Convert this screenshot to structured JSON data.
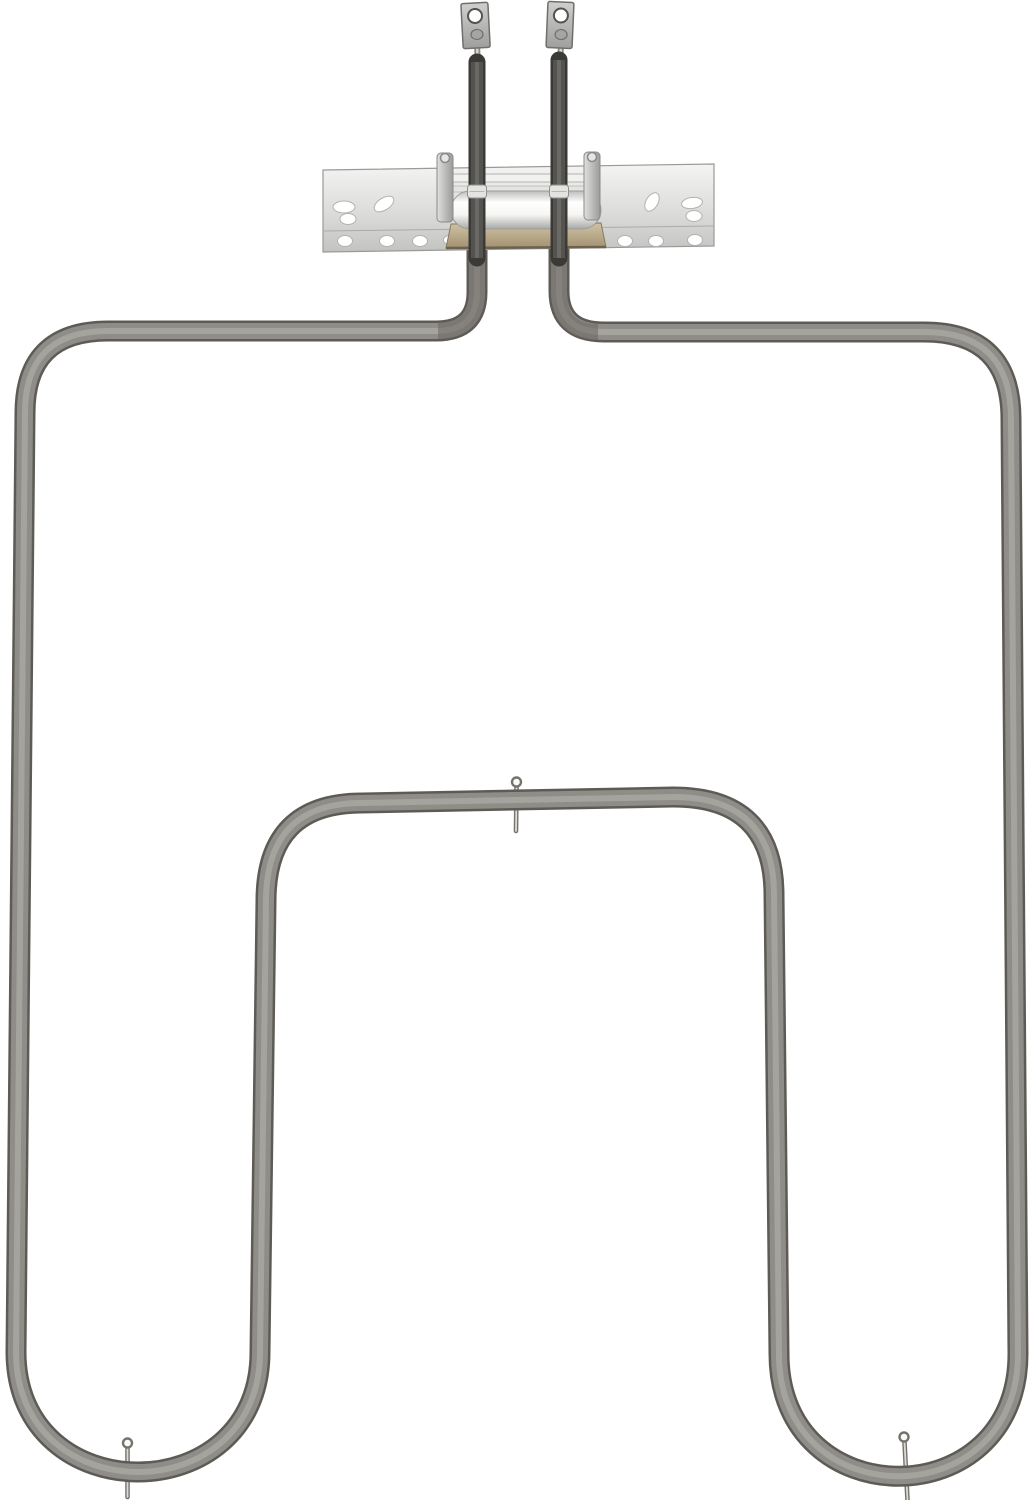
{
  "meta": {
    "domain": "Natural-Image",
    "subject": "Oven bake heating element replacement part photographed on a white background",
    "background_color": "#ffffff"
  },
  "object": {
    "description": "Large square-cornered outer tube loop descending from a top mounting bracket, with an inner upside-down-U run; two dark terminal sheaths pass through the bracket up to two metal spade terminals",
    "terminal_count": 2,
    "support_pin_count": 3,
    "bracket_hole_count": 14
  },
  "palette": {
    "background": "#ffffff",
    "tube_edge": "#5e5b56",
    "tube_body": "#8f8d88",
    "tube_highlight": "#a9a7a2",
    "terminal_sheath_dark": "#3c3a37",
    "terminal_sheath_mid": "#555350",
    "bracket_light": "#f4f4f2",
    "bracket_dark": "#c3c3c1",
    "bracket_edge": "#9a9a98",
    "base_plate_tan": "#b4a583",
    "pin_metal": "#76736e"
  },
  "drawing": {
    "viewbox": "0 0 1036 1500",
    "tube": {
      "path": "M 477,248 L 477,292 Q 477,331 436,331 L 108,331 Q 25,331 25,413 L 16,1352 C 16,1512 260,1512 260,1352 L 266,901 Q 266,803 362,803 L 673,797 Q 774,797 774,895 L 779,1354 C 779,1517 1018,1517 1018,1354 L 1011,419 Q 1011,332 924,332 L 604,332 Q 559,332 559,291 L 559,248",
      "passes": [
        {
          "color": "#5e5b56",
          "width": 21
        },
        {
          "color": "#8f8d88",
          "width": 16
        },
        {
          "color": "#a9a7a2",
          "width": 6
        }
      ],
      "elbow_shadows": [
        "M 477,250 L 477,292 Q 477,331 438,331",
        "M 559,250 L 559,291 Q 559,332 598,332"
      ],
      "elbow_shadow_color": "#6b6862",
      "elbow_shadow_width": 16,
      "elbow_shadow_opacity": 0.55
    },
    "pins": [
      {
        "x1": 516.5,
        "y1": 787,
        "x2": 516,
        "y2": 831,
        "loop": {
          "cx": 516.5,
          "cy": 782,
          "r": 4.5
        }
      },
      {
        "x1": 127.5,
        "y1": 1448,
        "x2": 127.5,
        "y2": 1497,
        "loop": {
          "cx": 127.5,
          "cy": 1443,
          "r": 4.5
        }
      },
      {
        "x1": 904.5,
        "y1": 1442,
        "x2": 907.5,
        "y2": 1500,
        "loop": {
          "cx": 904,
          "cy": 1437,
          "r": 4.5
        }
      }
    ],
    "bracket": {
      "strip": "323,170 714,164 714,246 323,252",
      "crease": {
        "x1": 323,
        "y1": 231,
        "x2": 714,
        "y2": 226
      },
      "holes": [
        {
          "cx": 344,
          "cy": 207,
          "rx": 11,
          "ry": 6,
          "rot": 0
        },
        {
          "cx": 348,
          "cy": 219,
          "rx": 8,
          "ry": 5.5,
          "rot": 0
        },
        {
          "cx": 384,
          "cy": 204,
          "rx": 11,
          "ry": 6,
          "rot": -33
        },
        {
          "cx": 345,
          "cy": 241,
          "rx": 7.5,
          "ry": 5.5,
          "rot": 0
        },
        {
          "cx": 387,
          "cy": 241,
          "rx": 7.5,
          "ry": 5.5,
          "rot": 0
        },
        {
          "cx": 420,
          "cy": 241,
          "rx": 7.5,
          "ry": 5.5,
          "rot": 0
        },
        {
          "cx": 451,
          "cy": 240,
          "rx": 7.5,
          "ry": 5,
          "rot": 0
        },
        {
          "cx": 652,
          "cy": 202,
          "rx": 10,
          "ry": 6,
          "rot": -60
        },
        {
          "cx": 692,
          "cy": 203,
          "rx": 10.5,
          "ry": 5.5,
          "rot": -8
        },
        {
          "cx": 694,
          "cy": 216,
          "rx": 8,
          "ry": 5.5,
          "rot": 0
        },
        {
          "cx": 592,
          "cy": 240,
          "rx": 7.5,
          "ry": 5,
          "rot": 0
        },
        {
          "cx": 625,
          "cy": 241,
          "rx": 7.5,
          "ry": 5.5,
          "rot": 0
        },
        {
          "cx": 656,
          "cy": 241,
          "rx": 7.5,
          "ry": 5.5,
          "rot": 0
        },
        {
          "cx": 695,
          "cy": 240,
          "rx": 7.5,
          "ry": 5.5,
          "rot": 0
        }
      ],
      "plate": "451,224 601,223 606,247 446,248",
      "plate_bottom_edge": {
        "x1": 446,
        "y1": 248,
        "x2": 606,
        "y2": 247
      },
      "rods": [
        {
          "x": 440,
          "y": 174,
          "w": 158,
          "h": 8
        },
        {
          "x": 440,
          "y": 186,
          "w": 158,
          "h": 6
        }
      ],
      "cylinder": {
        "x": 451,
        "y": 191,
        "w": 150,
        "h": 38
      },
      "clips": [
        {
          "x": 437,
          "y": 153,
          "w": 16,
          "h": 69
        },
        {
          "x": 584,
          "y": 152,
          "w": 16,
          "h": 68
        }
      ],
      "rivets": [
        {
          "cx": 445,
          "cy": 158,
          "r": 4.5
        },
        {
          "cx": 592,
          "cy": 157,
          "r": 4.5
        }
      ]
    },
    "terminals": {
      "necks": [
        {
          "x1": 477,
          "y1": 44,
          "x2": 478,
          "y2": 67
        },
        {
          "x1": 561,
          "y1": 44,
          "x2": 560,
          "y2": 67
        }
      ],
      "tubes": [
        {
          "x1": 477,
          "y1": 62,
          "x2": 477,
          "y2": 258
        },
        {
          "x1": 559,
          "y1": 60,
          "x2": 559,
          "y2": 258
        }
      ],
      "tube_passes": [
        {
          "color": "#3c3a37",
          "width": 17
        },
        {
          "color": "#555350",
          "width": 12
        },
        {
          "color": "#6b6965",
          "width": 4
        }
      ],
      "collars": [
        {
          "x": 467.5,
          "y": 185,
          "w": 19,
          "h": 13
        },
        {
          "x": 549.5,
          "y": 185,
          "w": 19,
          "h": 13
        }
      ],
      "tabs": [
        {
          "x": 462,
          "y": 3,
          "w": 27,
          "h": 45,
          "rot": -3,
          "cx": 475.5,
          "cy": 25,
          "hole": {
            "cx": 475.5,
            "cy": 16,
            "r": 7
          },
          "dimple": {
            "cx": 476.5,
            "cy": 34.5,
            "rx": 6,
            "ry": 5
          }
        },
        {
          "x": 547,
          "y": 2,
          "w": 26,
          "h": 46,
          "rot": 2.5,
          "cx": 560,
          "cy": 25,
          "hole": {
            "cx": 560.5,
            "cy": 15.5,
            "r": 7
          },
          "dimple": {
            "cx": 561.5,
            "cy": 34.5,
            "rx": 6,
            "ry": 5
          }
        }
      ]
    }
  }
}
